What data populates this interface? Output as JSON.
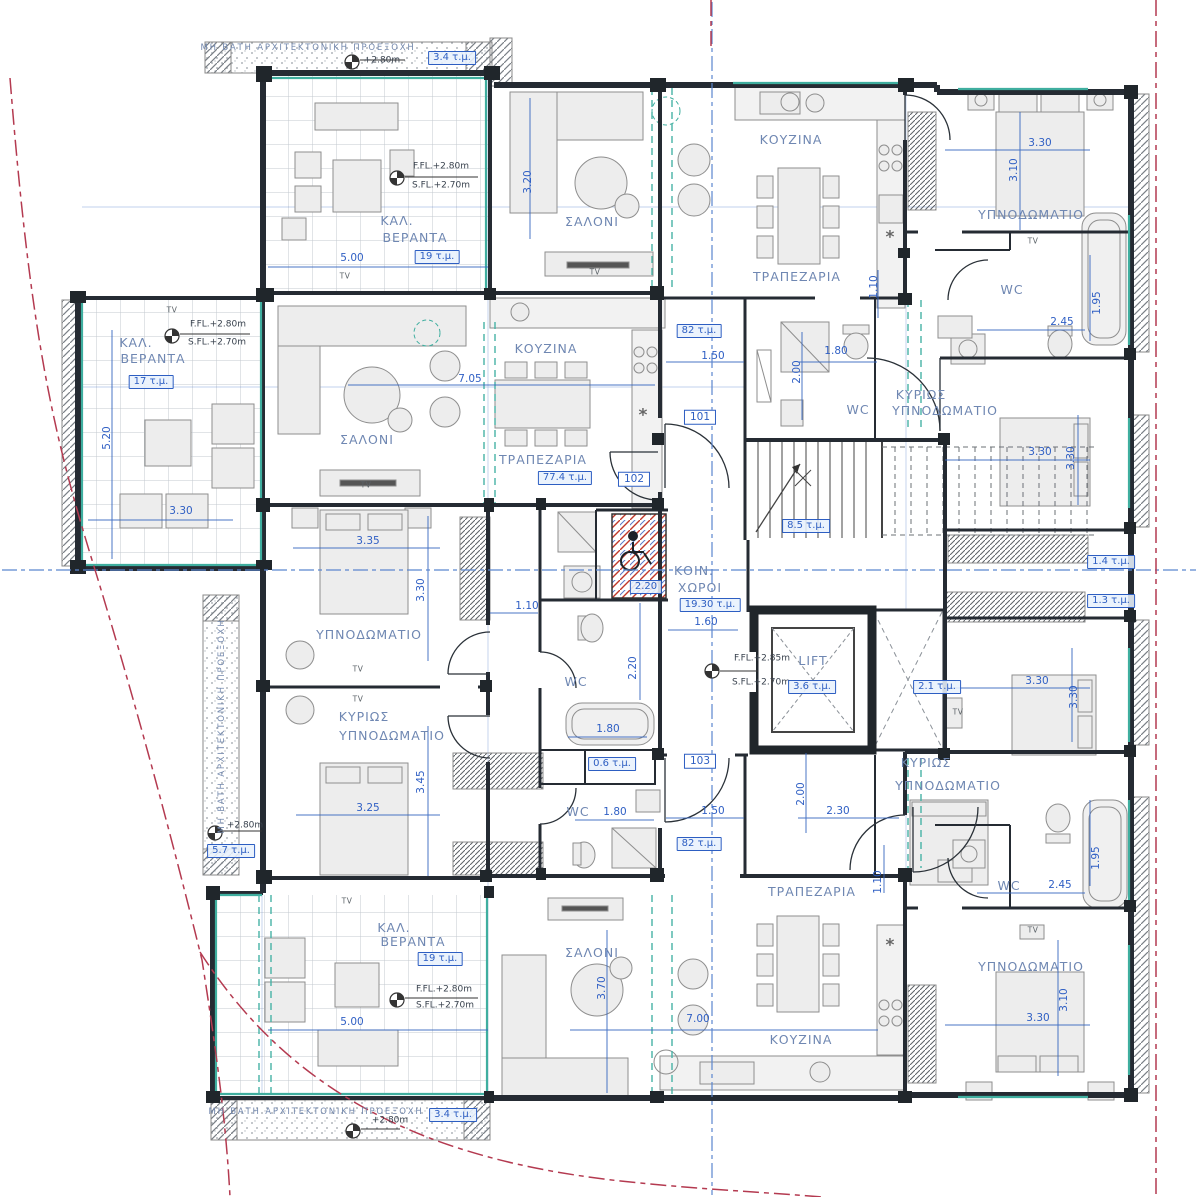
{
  "plan": {
    "colors": {
      "wall": "#252b33",
      "dimension_blue": "#2f5fc4",
      "room_label_blue": "#6f87b2",
      "glazing_teal": "#3fae9f",
      "boundary_red": "#b43a50",
      "axis_blue": "#5b86cf",
      "area_badge_blue": "#2d5ec2"
    },
    "labels": [
      {
        "text": "ΜΗ ΒΑΤΗ ΑΡΧΙΤΕΚΤΟΝΙΚΗ ΠΡΟΕΞΟΧΗ",
        "x": 308,
        "y": 48,
        "kind": "strip"
      },
      {
        "text": "+2.80m",
        "x": 382,
        "y": 61,
        "kind": "level"
      },
      {
        "text": "3.4 τ.μ.",
        "x": 452,
        "y": 58,
        "kind": "area"
      },
      {
        "text": "ΜΗ ΒΑΤΗ ΑΡΧΙΤΕΚΤΟΝΙΚΗ ΠΡΟΕΞΟΧΗ",
        "x": 316,
        "y": 1112,
        "kind": "strip"
      },
      {
        "text": "+2.80m",
        "x": 390,
        "y": 1121,
        "kind": "level"
      },
      {
        "text": "3.4 τ.μ.",
        "x": 453,
        "y": 1115,
        "kind": "area"
      },
      {
        "text": "ΜΗ ΒΑΤΗ ΑΡΧΙΤΕΚΤΟΝΙΚΗ ΠΡΟΕΞΟΧΗ",
        "x": 222,
        "y": 726,
        "kind": "strip",
        "v": 1
      },
      {
        "text": "+2.80m",
        "x": 245,
        "y": 826,
        "kind": "level"
      },
      {
        "text": "5.7 τ.μ.",
        "x": 231,
        "y": 851,
        "kind": "area"
      },
      {
        "text": "F.FL.+2.80m",
        "x": 441,
        "y": 167,
        "kind": "level"
      },
      {
        "text": "S.FL.+2.70m",
        "x": 441,
        "y": 186,
        "kind": "level"
      },
      {
        "text": "ΚΑΛ.",
        "x": 397,
        "y": 221,
        "kind": "room"
      },
      {
        "text": "ΒΕΡΑΝΤΑ",
        "x": 415,
        "y": 238,
        "kind": "room"
      },
      {
        "text": "5.00",
        "x": 352,
        "y": 258,
        "kind": "dim"
      },
      {
        "text": "19 τ.μ.",
        "x": 437,
        "y": 257,
        "kind": "area"
      },
      {
        "text": "TV",
        "x": 345,
        "y": 276,
        "kind": "tv"
      },
      {
        "text": "ΣΑΛΟΝΙ",
        "x": 592,
        "y": 222,
        "kind": "room"
      },
      {
        "text": "3.20",
        "x": 528,
        "y": 182,
        "kind": "dim",
        "v": 1
      },
      {
        "text": "TV",
        "x": 595,
        "y": 272,
        "kind": "tv"
      },
      {
        "text": "ΚΟΥΖΙΝΑ",
        "x": 791,
        "y": 140,
        "kind": "room"
      },
      {
        "text": "ΤΡΑΠΕΖΑΡΙΑ",
        "x": 797,
        "y": 277,
        "kind": "room"
      },
      {
        "text": "ΥΠΝΟΔΩΜΑΤΙΟ",
        "x": 1031,
        "y": 215,
        "kind": "room"
      },
      {
        "text": "3.30",
        "x": 1040,
        "y": 143,
        "kind": "dim"
      },
      {
        "text": "3.10",
        "x": 1014,
        "y": 170,
        "kind": "dim",
        "v": 1
      },
      {
        "text": "TV",
        "x": 1033,
        "y": 241,
        "kind": "tv"
      },
      {
        "text": "WC",
        "x": 1012,
        "y": 290,
        "kind": "room"
      },
      {
        "text": "2.45",
        "x": 1062,
        "y": 322,
        "kind": "dim"
      },
      {
        "text": "1.95",
        "x": 1097,
        "y": 303,
        "kind": "dim",
        "v": 1
      },
      {
        "text": "1.10",
        "x": 874,
        "y": 287,
        "kind": "dim",
        "v": 1
      },
      {
        "text": "82 τ.μ.",
        "x": 699,
        "y": 331,
        "kind": "area"
      },
      {
        "text": "1.50",
        "x": 713,
        "y": 356,
        "kind": "dim"
      },
      {
        "text": "101",
        "x": 700,
        "y": 417,
        "kind": "unit"
      },
      {
        "text": "1.80",
        "x": 836,
        "y": 351,
        "kind": "dim"
      },
      {
        "text": "2.00",
        "x": 797,
        "y": 372,
        "kind": "dim",
        "v": 1
      },
      {
        "text": "WC",
        "x": 858,
        "y": 410,
        "kind": "room"
      },
      {
        "text": "ΚΥΡΙΩΣ",
        "x": 921,
        "y": 395,
        "kind": "room"
      },
      {
        "text": "ΥΠΝΟΔΩΜΑΤΙΟ",
        "x": 945,
        "y": 411,
        "kind": "room"
      },
      {
        "text": "3.30",
        "x": 1040,
        "y": 452,
        "kind": "dim"
      },
      {
        "text": "3.30",
        "x": 1071,
        "y": 458,
        "kind": "dim",
        "v": 1
      },
      {
        "text": "TV",
        "x": 172,
        "y": 310,
        "kind": "tv"
      },
      {
        "text": "F.FL.+2.80m",
        "x": 218,
        "y": 325,
        "kind": "level"
      },
      {
        "text": "S.FL.+2.70m",
        "x": 217,
        "y": 343,
        "kind": "level"
      },
      {
        "text": "ΚΑΛ.",
        "x": 136,
        "y": 343,
        "kind": "room"
      },
      {
        "text": "ΒΕΡΑΝΤΑ",
        "x": 153,
        "y": 359,
        "kind": "room"
      },
      {
        "text": "17 τ.μ.",
        "x": 151,
        "y": 382,
        "kind": "area"
      },
      {
        "text": "5.20",
        "x": 107,
        "y": 438,
        "kind": "dim",
        "v": 1
      },
      {
        "text": "3.30",
        "x": 181,
        "y": 511,
        "kind": "dim"
      },
      {
        "text": "ΣΑΛΟΝΙ",
        "x": 367,
        "y": 440,
        "kind": "room"
      },
      {
        "text": "TV",
        "x": 366,
        "y": 485,
        "kind": "tv"
      },
      {
        "text": "ΚΟΥΖΙΝΑ",
        "x": 546,
        "y": 349,
        "kind": "room"
      },
      {
        "text": "7.05",
        "x": 470,
        "y": 379,
        "kind": "dim"
      },
      {
        "text": "ΤΡΑΠΕΖΑΡΙΑ",
        "x": 543,
        "y": 460,
        "kind": "room"
      },
      {
        "text": "77.4 τ.μ.",
        "x": 565,
        "y": 478,
        "kind": "area"
      },
      {
        "text": "102",
        "x": 634,
        "y": 479,
        "kind": "unit"
      },
      {
        "text": "3.35",
        "x": 368,
        "y": 541,
        "kind": "dim"
      },
      {
        "text": "ΥΠΝΟΔΩΜΑΤΙΟ",
        "x": 369,
        "y": 635,
        "kind": "room"
      },
      {
        "text": "3.30",
        "x": 421,
        "y": 590,
        "kind": "dim",
        "v": 1
      },
      {
        "text": "TV",
        "x": 358,
        "y": 669,
        "kind": "tv"
      },
      {
        "text": "TV",
        "x": 358,
        "y": 699,
        "kind": "tv"
      },
      {
        "text": "ΚΥΡΙΩΣ",
        "x": 364,
        "y": 717,
        "kind": "room"
      },
      {
        "text": "ΥΠΝΟΔΩΜΑΤΙΟ",
        "x": 392,
        "y": 736,
        "kind": "room"
      },
      {
        "text": "3.45",
        "x": 421,
        "y": 782,
        "kind": "dim",
        "v": 1
      },
      {
        "text": "3.25",
        "x": 368,
        "y": 808,
        "kind": "dim"
      },
      {
        "text": "1.10",
        "x": 527,
        "y": 606,
        "kind": "dim"
      },
      {
        "text": "WC",
        "x": 576,
        "y": 682,
        "kind": "room"
      },
      {
        "text": "2.20",
        "x": 633,
        "y": 668,
        "kind": "dim",
        "v": 1
      },
      {
        "text": "1.80",
        "x": 608,
        "y": 729,
        "kind": "dim"
      },
      {
        "text": "0.6 τ.μ.",
        "x": 612,
        "y": 764,
        "kind": "area"
      },
      {
        "text": "WC",
        "x": 578,
        "y": 812,
        "kind": "room"
      },
      {
        "text": "1.80",
        "x": 615,
        "y": 812,
        "kind": "dim"
      },
      {
        "text": "2.20",
        "x": 646,
        "y": 587,
        "kind": "area"
      },
      {
        "text": "ΚΟΙΝ.",
        "x": 694,
        "y": 571,
        "kind": "room"
      },
      {
        "text": "ΧΩΡΟΙ",
        "x": 700,
        "y": 588,
        "kind": "room"
      },
      {
        "text": "19.30 τ.μ.",
        "x": 710,
        "y": 605,
        "kind": "area"
      },
      {
        "text": "1.60",
        "x": 706,
        "y": 622,
        "kind": "dim"
      },
      {
        "text": "F.FL.+2.85m",
        "x": 762,
        "y": 659,
        "kind": "level"
      },
      {
        "text": "S.FL.+2.70m",
        "x": 761,
        "y": 683,
        "kind": "level"
      },
      {
        "text": "LIFT",
        "x": 813,
        "y": 661,
        "kind": "room"
      },
      {
        "text": "3.6 τ.μ.",
        "x": 812,
        "y": 687,
        "kind": "area"
      },
      {
        "text": "2.1 τ.μ.",
        "x": 937,
        "y": 687,
        "kind": "area"
      },
      {
        "text": "8.5 τ.μ.",
        "x": 806,
        "y": 526,
        "kind": "area"
      },
      {
        "text": "103",
        "x": 700,
        "y": 761,
        "kind": "unit"
      },
      {
        "text": "1.50",
        "x": 713,
        "y": 811,
        "kind": "dim"
      },
      {
        "text": "82 τ.μ.",
        "x": 699,
        "y": 844,
        "kind": "area"
      },
      {
        "text": "2.00",
        "x": 801,
        "y": 794,
        "kind": "dim",
        "v": 1
      },
      {
        "text": "2.30",
        "x": 838,
        "y": 811,
        "kind": "dim"
      },
      {
        "text": "1.10",
        "x": 878,
        "y": 882,
        "kind": "dim",
        "v": 1
      },
      {
        "text": "1.4 τ.μ.",
        "x": 1111,
        "y": 562,
        "kind": "area"
      },
      {
        "text": "1.3 τ.μ.",
        "x": 1111,
        "y": 601,
        "kind": "area"
      },
      {
        "text": "3.30",
        "x": 1037,
        "y": 681,
        "kind": "dim"
      },
      {
        "text": "3.30",
        "x": 1074,
        "y": 697,
        "kind": "dim",
        "v": 1
      },
      {
        "text": "TV",
        "x": 958,
        "y": 712,
        "kind": "tv"
      },
      {
        "text": "ΚΥΡΙΩΣ",
        "x": 926,
        "y": 763,
        "kind": "room"
      },
      {
        "text": "ΥΠΝΟΔΩΜΑΤΙΟ",
        "x": 948,
        "y": 786,
        "kind": "room"
      },
      {
        "text": "WC",
        "x": 1009,
        "y": 886,
        "kind": "room"
      },
      {
        "text": "2.45",
        "x": 1060,
        "y": 885,
        "kind": "dim"
      },
      {
        "text": "1.95",
        "x": 1096,
        "y": 858,
        "kind": "dim",
        "v": 1
      },
      {
        "text": "TV",
        "x": 1033,
        "y": 930,
        "kind": "tv"
      },
      {
        "text": "ΥΠΝΟΔΩΜΑΤΙΟ",
        "x": 1031,
        "y": 967,
        "kind": "room"
      },
      {
        "text": "3.30",
        "x": 1038,
        "y": 1018,
        "kind": "dim"
      },
      {
        "text": "3.10",
        "x": 1064,
        "y": 1000,
        "kind": "dim",
        "v": 1
      },
      {
        "text": "ΤΡΑΠΕΖΑΡΙΑ",
        "x": 812,
        "y": 892,
        "kind": "room"
      },
      {
        "text": "ΣΑΛΟΝΙ",
        "x": 592,
        "y": 953,
        "kind": "room"
      },
      {
        "text": "3.70",
        "x": 602,
        "y": 988,
        "kind": "dim",
        "v": 1
      },
      {
        "text": "7.00",
        "x": 698,
        "y": 1019,
        "kind": "dim"
      },
      {
        "text": "ΚΟΥΖΙΝΑ",
        "x": 801,
        "y": 1040,
        "kind": "room"
      },
      {
        "text": "TV",
        "x": 347,
        "y": 901,
        "kind": "tv"
      },
      {
        "text": "ΚΑΛ.",
        "x": 394,
        "y": 928,
        "kind": "room"
      },
      {
        "text": "ΒΕΡΑΝΤΑ",
        "x": 413,
        "y": 942,
        "kind": "room"
      },
      {
        "text": "19 τ.μ.",
        "x": 440,
        "y": 959,
        "kind": "area"
      },
      {
        "text": "F.FL.+2.80m",
        "x": 444,
        "y": 990,
        "kind": "level"
      },
      {
        "text": "S.FL.+2.70m",
        "x": 445,
        "y": 1006,
        "kind": "level"
      },
      {
        "text": "5.00",
        "x": 352,
        "y": 1022,
        "kind": "dim"
      },
      {
        "text": "*",
        "x": 890,
        "y": 238,
        "kind": "star"
      },
      {
        "text": "*",
        "x": 643,
        "y": 416,
        "kind": "star"
      },
      {
        "text": "*",
        "x": 890,
        "y": 946,
        "kind": "star"
      }
    ]
  }
}
